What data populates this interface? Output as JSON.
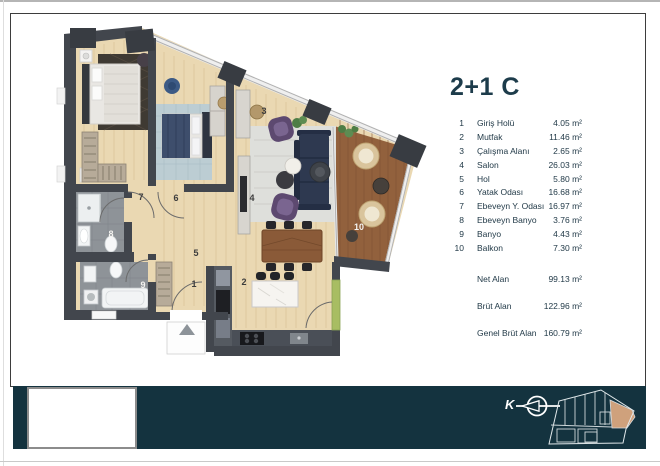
{
  "unit": {
    "title": "2+1 C"
  },
  "legend": {
    "rooms": [
      {
        "no": "1",
        "name": "Giriş Holü",
        "area": "4.05 m²"
      },
      {
        "no": "2",
        "name": "Mutfak",
        "area": "11.46 m²"
      },
      {
        "no": "3",
        "name": "Çalışma Alanı",
        "area": "2.65 m²"
      },
      {
        "no": "4",
        "name": "Salon",
        "area": "26.03 m²"
      },
      {
        "no": "5",
        "name": "Hol",
        "area": "5.80 m²"
      },
      {
        "no": "6",
        "name": "Yatak Odası",
        "area": "16.68 m²"
      },
      {
        "no": "7",
        "name": "Ebeveyn Y. Odası",
        "area": "16.97 m²"
      },
      {
        "no": "8",
        "name": "Ebeveyn Banyo",
        "area": "3.76 m²"
      },
      {
        "no": "9",
        "name": "Banyo",
        "area": "4.43 m²"
      },
      {
        "no": "10",
        "name": "Balkon",
        "area": "7.30 m²"
      }
    ],
    "summary": [
      {
        "label": "Net Alan",
        "value": "99.13 m²"
      },
      {
        "label": "Brüt Alan",
        "value": "122.96 m²"
      },
      {
        "label": "Genel Brüt Alan",
        "value": "160.79 m²"
      }
    ]
  },
  "plan": {
    "room_labels": [
      {
        "n": "1",
        "x": 194,
        "y": 284,
        "light": false
      },
      {
        "n": "2",
        "x": 244,
        "y": 282,
        "light": false
      },
      {
        "n": "3",
        "x": 264,
        "y": 111,
        "light": false
      },
      {
        "n": "4",
        "x": 252,
        "y": 198,
        "light": false
      },
      {
        "n": "5",
        "x": 196,
        "y": 253,
        "light": false
      },
      {
        "n": "6",
        "x": 176,
        "y": 198,
        "light": false
      },
      {
        "n": "7",
        "x": 141,
        "y": 197,
        "light": false
      },
      {
        "n": "8",
        "x": 111,
        "y": 234,
        "light": true
      },
      {
        "n": "9",
        "x": 143,
        "y": 285,
        "light": true
      },
      {
        "n": "10",
        "x": 359,
        "y": 227,
        "light": true
      }
    ]
  },
  "footer": {
    "compass_label": "K"
  },
  "colors": {
    "band_teal": "#14333f",
    "title_teal": "#1d3c4b",
    "wall": "#42464d",
    "wood_floor": "#ead8b2",
    "deck": "#92613d",
    "unit_highlight": "#cfa17c"
  }
}
